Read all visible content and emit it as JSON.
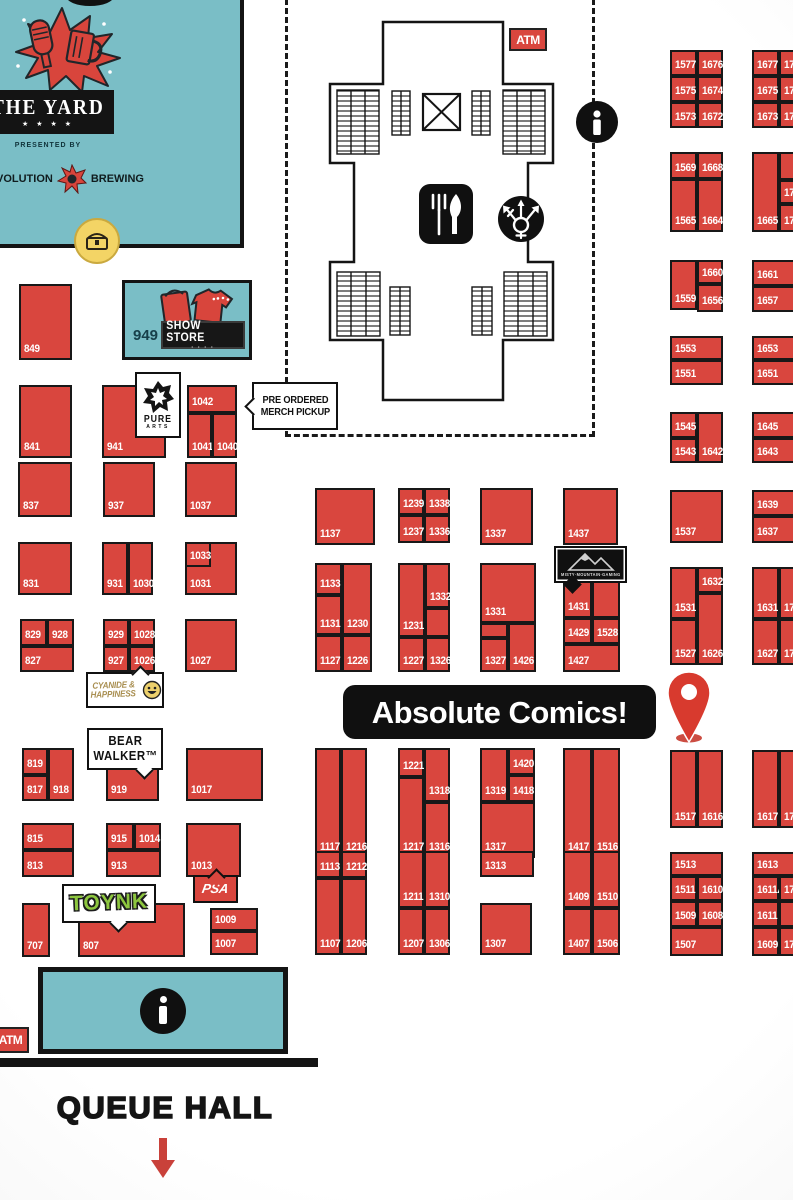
{
  "colors": {
    "booth_red": "#d9463e",
    "teal": "#7abec6",
    "black": "#141414",
    "pin_red": "#d83a2e",
    "toynk_green": "#8dc63f",
    "cyanide_tan": "#a98f51",
    "arrow_red": "#c9413a"
  },
  "icons": {
    "info": "info-icon",
    "food_court": "food-court-icon",
    "gender_neutral_restroom": "gender-neutral-restroom-icon",
    "elevator": "elevator-x-icon",
    "treasure_chest": "treasure-chest-icon",
    "map_pin": "map-pin-icon"
  },
  "labels": {
    "banner": "Absolute Comics!",
    "atm_top": "ATM",
    "atm_bottom": "ATM",
    "queue_hall": "QUEUE HALL",
    "pre_order_1": "PRE ORDERED",
    "pre_order_2": "MERCH PICKUP",
    "show_store_num": "949",
    "show_store": "SHOW STORE",
    "pure_1": "PURE",
    "pure_2": "ARTS",
    "bear_1": "BEAR",
    "bear_2": "WALKER™",
    "cyanide_1": "CYANIDE &",
    "cyanide_2": "HAPPINESS",
    "toynk": "TOYNK",
    "psa": "PSA",
    "misty": "MISTY·MOUNTAIN·GAMING",
    "yard_title": "THE YARD",
    "yard_stars": "★ ★ ★ ★",
    "yard_presented": "PRESENTED BY",
    "yard_rev_left": "VOLUTION",
    "yard_rev_right": "BREWING"
  },
  "booths": [
    {
      "n": "849",
      "x": 19,
      "y": 284,
      "w": 53,
      "h": 76
    },
    {
      "n": "841",
      "x": 19,
      "y": 385,
      "w": 53,
      "h": 73
    },
    {
      "n": "941",
      "x": 102,
      "y": 385,
      "w": 64,
      "h": 73
    },
    {
      "n": "1042",
      "x": 187,
      "y": 385,
      "w": 50,
      "h": 28
    },
    {
      "n": "1041",
      "x": 187,
      "y": 413,
      "w": 25,
      "h": 45
    },
    {
      "n": "1040",
      "x": 212,
      "y": 413,
      "w": 25,
      "h": 45
    },
    {
      "n": "837",
      "x": 18,
      "y": 462,
      "w": 54,
      "h": 55
    },
    {
      "n": "937",
      "x": 103,
      "y": 462,
      "w": 52,
      "h": 55
    },
    {
      "n": "1037",
      "x": 185,
      "y": 462,
      "w": 52,
      "h": 55
    },
    {
      "n": "831",
      "x": 18,
      "y": 542,
      "w": 54,
      "h": 53
    },
    {
      "n": "931",
      "x": 102,
      "y": 542,
      "w": 26,
      "h": 53
    },
    {
      "n": "1030",
      "x": 128,
      "y": 542,
      "w": 25,
      "h": 53
    },
    {
      "n": "1031",
      "x": 185,
      "y": 542,
      "w": 52,
      "h": 53
    },
    {
      "n": "1033",
      "x": 185,
      "y": 542,
      "w": 26,
      "h": 25
    },
    {
      "n": "829",
      "x": 20,
      "y": 619,
      "w": 27,
      "h": 27
    },
    {
      "n": "928",
      "x": 47,
      "y": 619,
      "w": 27,
      "h": 27
    },
    {
      "n": "827",
      "x": 20,
      "y": 646,
      "w": 54,
      "h": 26
    },
    {
      "n": "929",
      "x": 103,
      "y": 619,
      "w": 26,
      "h": 27
    },
    {
      "n": "1028",
      "x": 129,
      "y": 619,
      "w": 26,
      "h": 27
    },
    {
      "n": "927",
      "x": 103,
      "y": 646,
      "w": 26,
      "h": 26
    },
    {
      "n": "1026",
      "x": 129,
      "y": 646,
      "w": 26,
      "h": 26
    },
    {
      "n": "1027",
      "x": 185,
      "y": 619,
      "w": 52,
      "h": 53
    },
    {
      "n": "819",
      "x": 22,
      "y": 748,
      "w": 26,
      "h": 27
    },
    {
      "n": "817",
      "x": 22,
      "y": 775,
      "w": 26,
      "h": 26
    },
    {
      "n": "918",
      "x": 48,
      "y": 748,
      "w": 26,
      "h": 53
    },
    {
      "n": "919",
      "x": 106,
      "y": 755,
      "w": 53,
      "h": 46
    },
    {
      "n": "1017",
      "x": 186,
      "y": 748,
      "w": 77,
      "h": 53
    },
    {
      "n": "815",
      "x": 22,
      "y": 823,
      "w": 52,
      "h": 27
    },
    {
      "n": "813",
      "x": 22,
      "y": 850,
      "w": 52,
      "h": 27
    },
    {
      "n": "915",
      "x": 106,
      "y": 823,
      "w": 28,
      "h": 27
    },
    {
      "n": "1014",
      "x": 134,
      "y": 823,
      "w": 27,
      "h": 27
    },
    {
      "n": "913",
      "x": 106,
      "y": 850,
      "w": 55,
      "h": 27
    },
    {
      "n": "1013",
      "x": 186,
      "y": 823,
      "w": 55,
      "h": 54
    },
    {
      "n": "707",
      "x": 22,
      "y": 903,
      "w": 28,
      "h": 54
    },
    {
      "n": "807",
      "x": 78,
      "y": 903,
      "w": 107,
      "h": 54
    },
    {
      "n": "1009",
      "x": 210,
      "y": 908,
      "w": 48,
      "h": 23
    },
    {
      "n": "1007",
      "x": 210,
      "y": 931,
      "w": 48,
      "h": 24
    },
    {
      "n": "1137",
      "x": 315,
      "y": 488,
      "w": 60,
      "h": 57
    },
    {
      "n": "1239",
      "x": 398,
      "y": 488,
      "w": 26,
      "h": 27
    },
    {
      "n": "1338",
      "x": 424,
      "y": 488,
      "w": 26,
      "h": 27
    },
    {
      "n": "1237",
      "x": 398,
      "y": 515,
      "w": 26,
      "h": 28
    },
    {
      "n": "1336",
      "x": 424,
      "y": 515,
      "w": 26,
      "h": 28
    },
    {
      "n": "1337",
      "x": 480,
      "y": 488,
      "w": 53,
      "h": 57
    },
    {
      "n": "1437",
      "x": 563,
      "y": 488,
      "w": 55,
      "h": 57
    },
    {
      "n": "1133",
      "x": 315,
      "y": 563,
      "w": 27,
      "h": 32
    },
    {
      "n": "1131",
      "x": 315,
      "y": 595,
      "w": 27,
      "h": 40
    },
    {
      "n": "1230",
      "x": 342,
      "y": 563,
      "w": 30,
      "h": 72
    },
    {
      "n": "1127",
      "x": 315,
      "y": 635,
      "w": 27,
      "h": 37
    },
    {
      "n": "1226",
      "x": 342,
      "y": 635,
      "w": 30,
      "h": 37
    },
    {
      "n": "1231",
      "x": 398,
      "y": 563,
      "w": 27,
      "h": 74
    },
    {
      "n": "1332",
      "x": 425,
      "y": 563,
      "w": 25,
      "h": 45
    },
    {
      "n": "",
      "x": 425,
      "y": 608,
      "w": 25,
      "h": 29
    },
    {
      "n": "1227",
      "x": 398,
      "y": 637,
      "w": 27,
      "h": 35
    },
    {
      "n": "1326",
      "x": 425,
      "y": 637,
      "w": 25,
      "h": 35
    },
    {
      "n": "1331",
      "x": 480,
      "y": 563,
      "w": 56,
      "h": 60
    },
    {
      "n": "",
      "x": 480,
      "y": 623,
      "w": 28,
      "h": 15
    },
    {
      "n": "1327",
      "x": 480,
      "y": 638,
      "w": 28,
      "h": 34
    },
    {
      "n": "1426",
      "x": 508,
      "y": 623,
      "w": 28,
      "h": 49
    },
    {
      "n": "1431",
      "x": 563,
      "y": 563,
      "w": 29,
      "h": 55
    },
    {
      "n": "",
      "x": 592,
      "y": 563,
      "w": 28,
      "h": 55
    },
    {
      "n": "1429",
      "x": 563,
      "y": 618,
      "w": 29,
      "h": 26
    },
    {
      "n": "1528",
      "x": 592,
      "y": 618,
      "w": 28,
      "h": 26
    },
    {
      "n": "1427",
      "x": 563,
      "y": 644,
      "w": 57,
      "h": 28
    },
    {
      "n": "1117",
      "x": 315,
      "y": 748,
      "w": 26,
      "h": 110
    },
    {
      "n": "1216",
      "x": 341,
      "y": 748,
      "w": 26,
      "h": 110
    },
    {
      "n": "1221",
      "x": 398,
      "y": 748,
      "w": 26,
      "h": 29
    },
    {
      "n": "1217",
      "x": 398,
      "y": 777,
      "w": 26,
      "h": 81
    },
    {
      "n": "1318",
      "x": 424,
      "y": 748,
      "w": 26,
      "h": 54
    },
    {
      "n": "1316",
      "x": 424,
      "y": 802,
      "w": 26,
      "h": 56
    },
    {
      "n": "1319",
      "x": 480,
      "y": 748,
      "w": 28,
      "h": 54
    },
    {
      "n": "1420",
      "x": 508,
      "y": 748,
      "w": 27,
      "h": 27
    },
    {
      "n": "1418",
      "x": 508,
      "y": 775,
      "w": 27,
      "h": 27
    },
    {
      "n": "1317",
      "x": 480,
      "y": 802,
      "w": 55,
      "h": 56
    },
    {
      "n": "1417",
      "x": 563,
      "y": 748,
      "w": 29,
      "h": 110
    },
    {
      "n": "1516",
      "x": 592,
      "y": 748,
      "w": 28,
      "h": 110
    },
    {
      "n": "1113",
      "x": 315,
      "y": 851,
      "w": 26,
      "h": 27
    },
    {
      "n": "1212",
      "x": 341,
      "y": 851,
      "w": 26,
      "h": 27
    },
    {
      "n": "1107",
      "x": 315,
      "y": 878,
      "w": 26,
      "h": 77
    },
    {
      "n": "1206",
      "x": 341,
      "y": 878,
      "w": 26,
      "h": 77
    },
    {
      "n": "1211",
      "x": 398,
      "y": 851,
      "w": 26,
      "h": 57
    },
    {
      "n": "1310",
      "x": 424,
      "y": 851,
      "w": 26,
      "h": 57
    },
    {
      "n": "1207",
      "x": 398,
      "y": 908,
      "w": 26,
      "h": 47
    },
    {
      "n": "1306",
      "x": 424,
      "y": 908,
      "w": 26,
      "h": 47
    },
    {
      "n": "1313",
      "x": 480,
      "y": 851,
      "w": 54,
      "h": 26
    },
    {
      "n": "1307",
      "x": 480,
      "y": 903,
      "w": 52,
      "h": 52
    },
    {
      "n": "1409",
      "x": 563,
      "y": 851,
      "w": 29,
      "h": 57
    },
    {
      "n": "1510",
      "x": 592,
      "y": 851,
      "w": 28,
      "h": 57
    },
    {
      "n": "1407",
      "x": 563,
      "y": 908,
      "w": 29,
      "h": 47
    },
    {
      "n": "1506",
      "x": 592,
      "y": 908,
      "w": 28,
      "h": 47
    },
    {
      "n": "1577",
      "x": 670,
      "y": 50,
      "w": 27,
      "h": 26
    },
    {
      "n": "1676",
      "x": 697,
      "y": 50,
      "w": 26,
      "h": 26
    },
    {
      "n": "1575",
      "x": 670,
      "y": 76,
      "w": 27,
      "h": 26
    },
    {
      "n": "1674",
      "x": 697,
      "y": 76,
      "w": 26,
      "h": 26
    },
    {
      "n": "1573",
      "x": 670,
      "y": 102,
      "w": 27,
      "h": 26
    },
    {
      "n": "1672",
      "x": 697,
      "y": 102,
      "w": 26,
      "h": 26
    },
    {
      "n": "1569",
      "x": 670,
      "y": 152,
      "w": 27,
      "h": 27
    },
    {
      "n": "1668",
      "x": 697,
      "y": 152,
      "w": 26,
      "h": 27
    },
    {
      "n": "1565",
      "x": 670,
      "y": 179,
      "w": 27,
      "h": 53
    },
    {
      "n": "1664",
      "x": 697,
      "y": 179,
      "w": 26,
      "h": 53
    },
    {
      "n": "1559",
      "x": 670,
      "y": 260,
      "w": 27,
      "h": 50
    },
    {
      "n": "1660",
      "x": 697,
      "y": 260,
      "w": 26,
      "h": 24
    },
    {
      "n": "1656",
      "x": 697,
      "y": 284,
      "w": 26,
      "h": 28
    },
    {
      "n": "1553",
      "x": 670,
      "y": 336,
      "w": 53,
      "h": 24
    },
    {
      "n": "1551",
      "x": 670,
      "y": 360,
      "w": 53,
      "h": 25
    },
    {
      "n": "1545",
      "x": 670,
      "y": 412,
      "w": 27,
      "h": 26
    },
    {
      "n": "1543",
      "x": 670,
      "y": 438,
      "w": 27,
      "h": 25
    },
    {
      "n": "1642",
      "x": 697,
      "y": 412,
      "w": 26,
      "h": 51
    },
    {
      "n": "1537",
      "x": 670,
      "y": 490,
      "w": 53,
      "h": 53
    },
    {
      "n": "1531",
      "x": 670,
      "y": 567,
      "w": 27,
      "h": 52
    },
    {
      "n": "1527",
      "x": 670,
      "y": 619,
      "w": 27,
      "h": 46
    },
    {
      "n": "1632",
      "x": 697,
      "y": 567,
      "w": 26,
      "h": 26
    },
    {
      "n": "1626",
      "x": 697,
      "y": 593,
      "w": 26,
      "h": 72
    },
    {
      "n": "1517",
      "x": 670,
      "y": 750,
      "w": 27,
      "h": 78
    },
    {
      "n": "1616",
      "x": 697,
      "y": 750,
      "w": 26,
      "h": 78
    },
    {
      "n": "1513",
      "x": 670,
      "y": 852,
      "w": 53,
      "h": 24
    },
    {
      "n": "1511",
      "x": 670,
      "y": 876,
      "w": 27,
      "h": 25
    },
    {
      "n": "1610",
      "x": 697,
      "y": 876,
      "w": 26,
      "h": 25
    },
    {
      "n": "1509",
      "x": 670,
      "y": 901,
      "w": 27,
      "h": 26
    },
    {
      "n": "1608",
      "x": 697,
      "y": 901,
      "w": 26,
      "h": 26
    },
    {
      "n": "1507",
      "x": 670,
      "y": 927,
      "w": 53,
      "h": 29
    },
    {
      "n": "1677",
      "x": 752,
      "y": 50,
      "w": 27,
      "h": 26
    },
    {
      "n": "17",
      "x": 779,
      "y": 50,
      "w": 30,
      "h": 26
    },
    {
      "n": "1675",
      "x": 752,
      "y": 76,
      "w": 27,
      "h": 26
    },
    {
      "n": "17",
      "x": 779,
      "y": 76,
      "w": 30,
      "h": 26
    },
    {
      "n": "1673",
      "x": 752,
      "y": 102,
      "w": 27,
      "h": 26
    },
    {
      "n": "17",
      "x": 779,
      "y": 102,
      "w": 30,
      "h": 26
    },
    {
      "n": "1665",
      "x": 752,
      "y": 152,
      "w": 27,
      "h": 80
    },
    {
      "n": "",
      "x": 779,
      "y": 152,
      "w": 30,
      "h": 28
    },
    {
      "n": "176",
      "x": 779,
      "y": 180,
      "w": 30,
      "h": 24
    },
    {
      "n": "176",
      "x": 779,
      "y": 204,
      "w": 30,
      "h": 28
    },
    {
      "n": "1661",
      "x": 752,
      "y": 260,
      "w": 45,
      "h": 26
    },
    {
      "n": "1657",
      "x": 752,
      "y": 286,
      "w": 45,
      "h": 26
    },
    {
      "n": "1653",
      "x": 752,
      "y": 336,
      "w": 45,
      "h": 24
    },
    {
      "n": "1651",
      "x": 752,
      "y": 360,
      "w": 45,
      "h": 25
    },
    {
      "n": "1645",
      "x": 752,
      "y": 412,
      "w": 45,
      "h": 26
    },
    {
      "n": "1643",
      "x": 752,
      "y": 438,
      "w": 45,
      "h": 25
    },
    {
      "n": "1639",
      "x": 752,
      "y": 490,
      "w": 45,
      "h": 26
    },
    {
      "n": "1637",
      "x": 752,
      "y": 516,
      "w": 45,
      "h": 27
    },
    {
      "n": "1631",
      "x": 752,
      "y": 567,
      "w": 27,
      "h": 52
    },
    {
      "n": "17",
      "x": 779,
      "y": 567,
      "w": 30,
      "h": 52
    },
    {
      "n": "1627",
      "x": 752,
      "y": 619,
      "w": 27,
      "h": 46
    },
    {
      "n": "17",
      "x": 779,
      "y": 619,
      "w": 30,
      "h": 46
    },
    {
      "n": "1617",
      "x": 752,
      "y": 750,
      "w": 27,
      "h": 78
    },
    {
      "n": "17",
      "x": 779,
      "y": 750,
      "w": 30,
      "h": 78
    },
    {
      "n": "1613",
      "x": 752,
      "y": 852,
      "w": 45,
      "h": 24
    },
    {
      "n": "1611A",
      "x": 752,
      "y": 876,
      "w": 27,
      "h": 25
    },
    {
      "n": "17",
      "x": 779,
      "y": 876,
      "w": 30,
      "h": 25
    },
    {
      "n": "1611",
      "x": 752,
      "y": 901,
      "w": 27,
      "h": 26
    },
    {
      "n": "",
      "x": 779,
      "y": 901,
      "w": 30,
      "h": 26
    },
    {
      "n": "1609",
      "x": 752,
      "y": 927,
      "w": 27,
      "h": 29
    },
    {
      "n": "170",
      "x": 779,
      "y": 927,
      "w": 30,
      "h": 29
    }
  ]
}
